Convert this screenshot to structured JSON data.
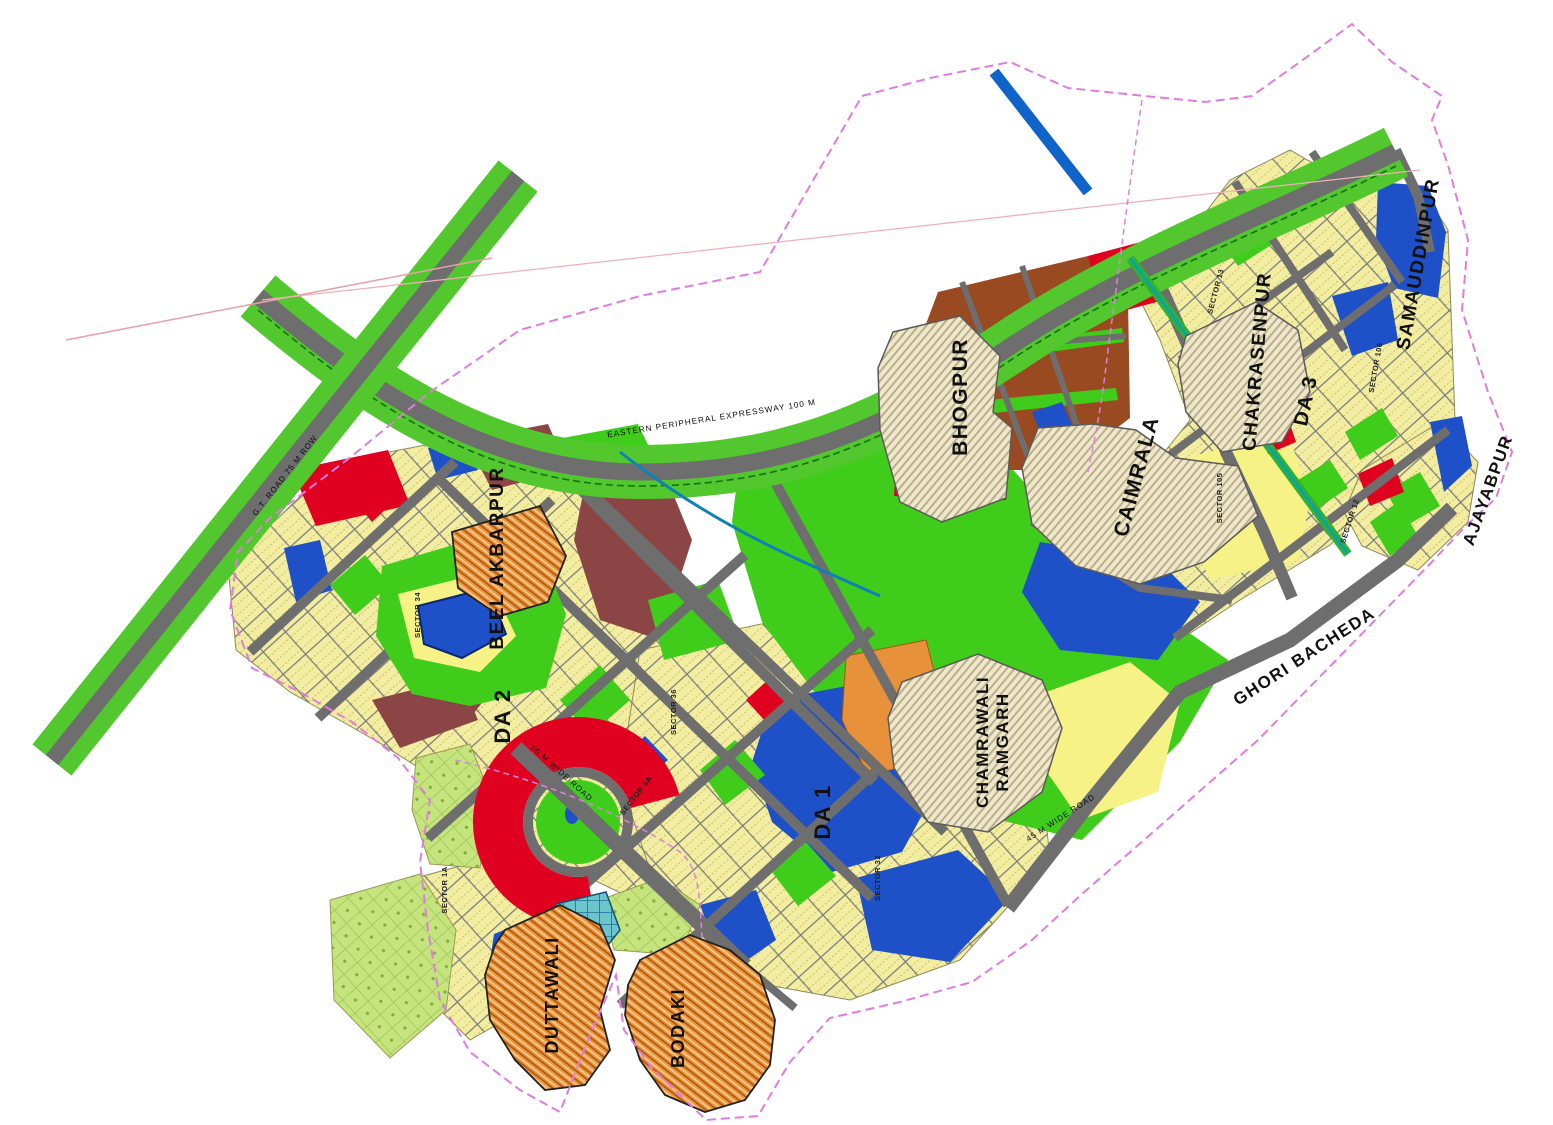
{
  "map": {
    "region_labels": [
      {
        "id": "bhogpur",
        "text": "BHOGPUR"
      },
      {
        "id": "caimrala",
        "text": "CAIMRALA"
      },
      {
        "id": "chakrasenpur",
        "text": "CHAKRASENPUR"
      },
      {
        "id": "samauddinpur",
        "text": "SAMAUDDINPUR"
      },
      {
        "id": "ajayabpur",
        "text": "AJAYABPUR"
      },
      {
        "id": "ghori-bacheda",
        "text": "GHORI BACHEDA"
      },
      {
        "id": "beel-akbarpur",
        "text": "BEEL AKBARPUR"
      },
      {
        "id": "chamrawali",
        "text": "CHAMRAWALI"
      },
      {
        "id": "ramgarh",
        "text": "RAMGARH"
      },
      {
        "id": "duttawali",
        "text": "DUTTAWALI"
      },
      {
        "id": "bodaki",
        "text": "BODAKI"
      },
      {
        "id": "da-1",
        "text": "DA 1"
      },
      {
        "id": "da-2",
        "text": "DA 2"
      },
      {
        "id": "da-3",
        "text": "DA 3"
      }
    ],
    "road_labels": [
      {
        "text": "EASTERN PERIPHERAL EXPRESSWAY 100 M"
      },
      {
        "text": "G.T. ROAD 75 M ROW"
      },
      {
        "text": "60 M WIDE ROAD"
      },
      {
        "text": "45 M WIDE ROAD"
      }
    ],
    "sector_labels": [
      {
        "text": "SECTOR 34"
      },
      {
        "text": "SECTOR 36"
      },
      {
        "text": "SECTOR 32"
      },
      {
        "text": "SECTOR 105"
      },
      {
        "text": "SECTOR 106"
      },
      {
        "text": "SECTOR 12"
      },
      {
        "text": "SECTOR 13"
      },
      {
        "text": "SECTOR 1A"
      },
      {
        "text": "SECTOR 5A"
      }
    ],
    "colors": {
      "residential_blocks": "#F2EDA0",
      "plain_yellow_parcel": "#F6F286",
      "commercial_red": "#E00020",
      "industrial_brown": "#9A4A20",
      "institutional_maroon": "#8C4545",
      "parks_green": "#3FCC1A",
      "green_belt": "#52C72E",
      "water_blue": "#1E50C8",
      "village_abadi_orange": "#E8913B",
      "existing_abadi_cream": "#EFE7C9",
      "planned_village_chartreuse": "#C6E47E",
      "road_gray": "#6E6E6E",
      "boundary_magenta": "#E07CE0",
      "canal_blue": "#1063C8",
      "drain_teal": "#0FA0A8"
    }
  }
}
